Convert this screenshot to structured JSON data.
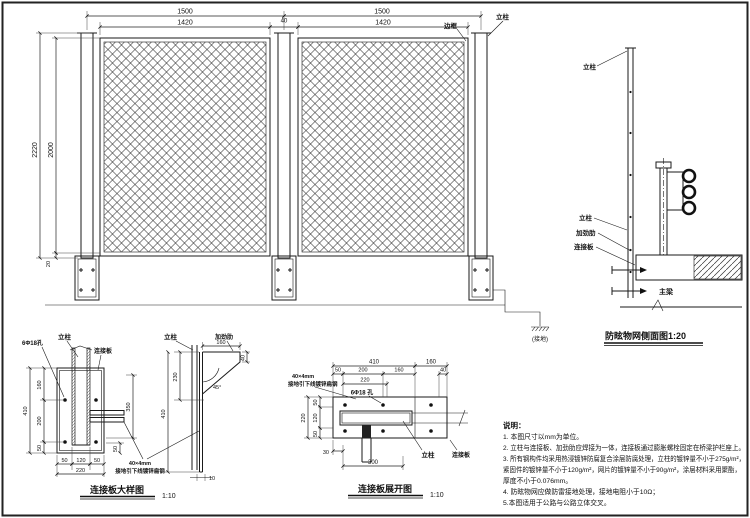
{
  "sheet": {
    "background": "#ffffff",
    "line_color": "#1a1a1a"
  },
  "elevation": {
    "dims": {
      "span_left": "1500",
      "span_right": "1500",
      "panel_left": "1420",
      "panel_gap": "40",
      "panel_right": "1420",
      "height_total": "2220",
      "height_mesh": "2000",
      "height_bottom": "20"
    },
    "labels": {
      "frame": "边框",
      "post": "立柱",
      "ground": "(接地)"
    }
  },
  "side_view": {
    "title": "防眩物网侧面图1:20",
    "labels": {
      "post_top": "立柱",
      "post": "立柱",
      "stiffener": "加劲肋",
      "plate": "连接板",
      "beam": "主梁"
    }
  },
  "detail_plate": {
    "caption": "连接板大样图",
    "scale": "1:10",
    "labels": {
      "holes": "6Φ18孔",
      "post": "立柱",
      "plate": "连接板",
      "post_side": "立柱",
      "stiffener_side": "加劲肋",
      "angle": "45°",
      "lead_line1": "40×4mm",
      "lead_line2": "接地引下线镀锌扁钢"
    },
    "dims": {
      "seg1": "160",
      "seg2": "200",
      "seg3": "50",
      "total_height": "410",
      "bottom1": "50",
      "bottom2": "120",
      "bottom3": "50",
      "bottom_total": "220",
      "bar": "350",
      "corner": "50",
      "side_top": "160",
      "side_leg": "40",
      "side_inner": "230",
      "side_total": "410",
      "plate_thickness": "10"
    }
  },
  "detail_dev": {
    "caption": "连接板展开图",
    "scale": "1:10",
    "labels": {
      "holes": "6Φ18 孔",
      "post": "立柱",
      "plate": "连接板",
      "lead_line1": "40×4mm",
      "lead_line2": "接地引下线镀锌扁钢"
    },
    "dims": {
      "top1": "410",
      "top2": "160",
      "row1": "50",
      "row2": "200",
      "row3": "160",
      "row4": "40",
      "holes_span": "220",
      "left1": "50",
      "left2": "120",
      "left3": "50",
      "left_total": "220",
      "bottom1": "30",
      "bottom2": "300"
    }
  },
  "notes": {
    "heading": "说明：",
    "lines": [
      "1. 本图尺寸以mm为单位。",
      "2. 立柱与连接板、加劲肋应焊接为一体，连接板通过膨胀螺栓固定在桥梁护栏座上。",
      "3. 所有钢构件均采用热浸镀锌防腐复合涂层防腐处理，立柱的镀锌量不小于275g/m²，",
      "紧固件的镀锌量不小于120g/m²，网片的镀锌量不小于90g/m²，涂层材料采用聚酯，",
      "厚度不小于0.076mm。",
      "4. 防眩物网应做防雷接地处理，接地电阻小于10Ω；",
      "5.本图适用于公路与公路立体交叉。"
    ]
  }
}
